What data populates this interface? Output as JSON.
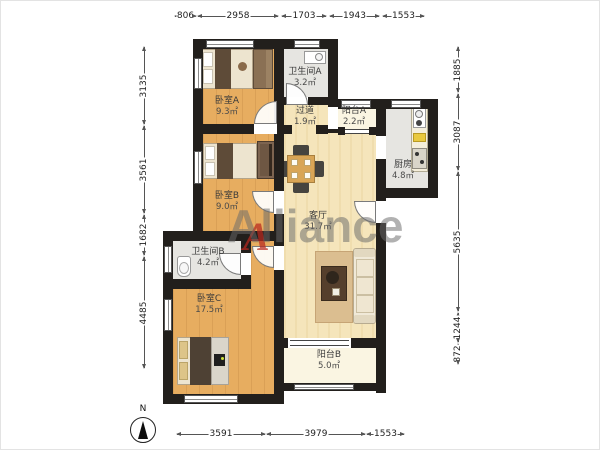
{
  "title": "apartment-floor-plan",
  "watermark": {
    "text": "Alliance",
    "accent_letter": "A",
    "accent_color": "#B9281E",
    "text_color": "#696969"
  },
  "compass": {
    "label": "N"
  },
  "rooms": [
    {
      "name": "卧室A",
      "area": "9.3㎡"
    },
    {
      "name": "卫生间A",
      "area": "3.2㎡"
    },
    {
      "name": "过道",
      "area": "1.9㎡"
    },
    {
      "name": "阳台A",
      "area": "2.2㎡"
    },
    {
      "name": "厨房",
      "area": "4.8㎡"
    },
    {
      "name": "卧室B",
      "area": "9.0㎡"
    },
    {
      "name": "客厅",
      "area": "31.7㎡"
    },
    {
      "name": "卫生间B",
      "area": "4.2㎡"
    },
    {
      "name": "卧室C",
      "area": "17.5㎡"
    },
    {
      "name": "阳台B",
      "area": "5.0㎡"
    }
  ],
  "dimensions": {
    "top": [
      "806",
      "2958",
      "1703",
      "1943",
      "1553"
    ],
    "left": [
      "3135",
      "3561",
      "1682",
      "4485"
    ],
    "right": [
      "1885",
      "3087",
      "5635",
      "1244",
      "872"
    ],
    "bottom": [
      "3591",
      "3979",
      "1553"
    ]
  },
  "colors": {
    "wall": "#221F1C",
    "bedroom_floor": "#E7AD60",
    "living_floor": "#F5E5BB",
    "tile_floor": "#E6E5E1",
    "balcony_floor": "#FAF5E2"
  }
}
